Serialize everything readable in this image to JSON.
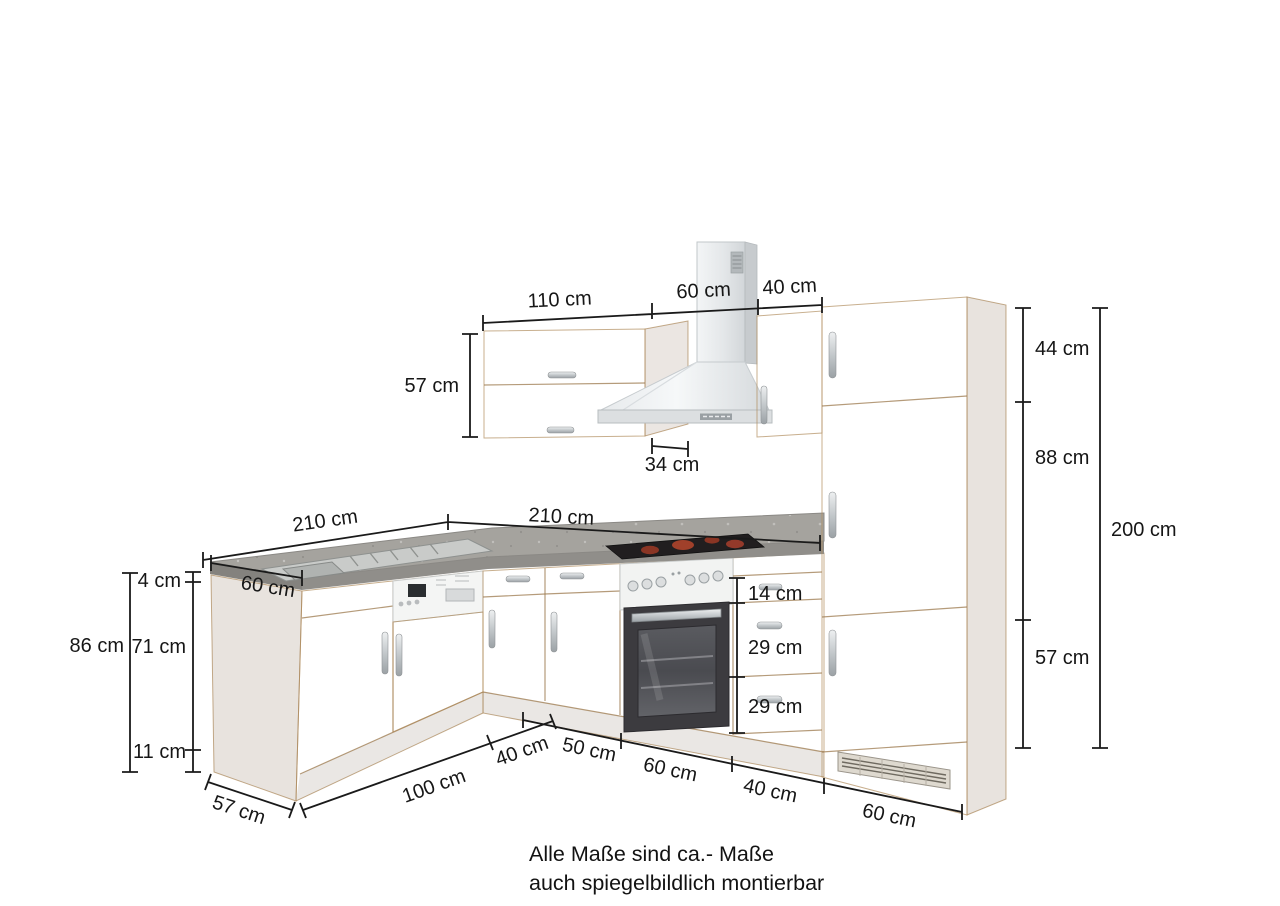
{
  "dims": {
    "top": {
      "w110": "110 cm",
      "w60": "60 cm",
      "w40": "40 cm"
    },
    "wall": {
      "height": "57 cm",
      "depth": "34 cm"
    },
    "tall": {
      "s1": "44 cm",
      "s2": "88 cm",
      "s3": "57 cm",
      "total": "200 cm"
    },
    "counter": {
      "left": "210 cm",
      "right": "210 cm",
      "depth": "60 cm",
      "thick": "4 cm"
    },
    "base": {
      "height": "86 cm",
      "door": "71 cm",
      "plinth": "11 cm"
    },
    "drawers": [
      "14 cm",
      "29 cm",
      "29 cm"
    ],
    "bottom": {
      "depth": "57 cm",
      "b100": "100 cm",
      "b40": "40 cm",
      "r50": "50 cm",
      "r60a": "60 cm",
      "r40": "40 cm",
      "r60b": "60 cm"
    }
  },
  "footer": {
    "line1": "Alle Maße sind ca.- Maße",
    "line2": "auch spiegelbildlich montierbar"
  },
  "colors": {
    "wood": "#d6b78f",
    "worktop": "#a5a39e",
    "stainless": "#e9ebed",
    "dimension_line": "#1a1a1a",
    "oven_door": "#3c3b3f",
    "hob_glow": "#a0402a"
  }
}
